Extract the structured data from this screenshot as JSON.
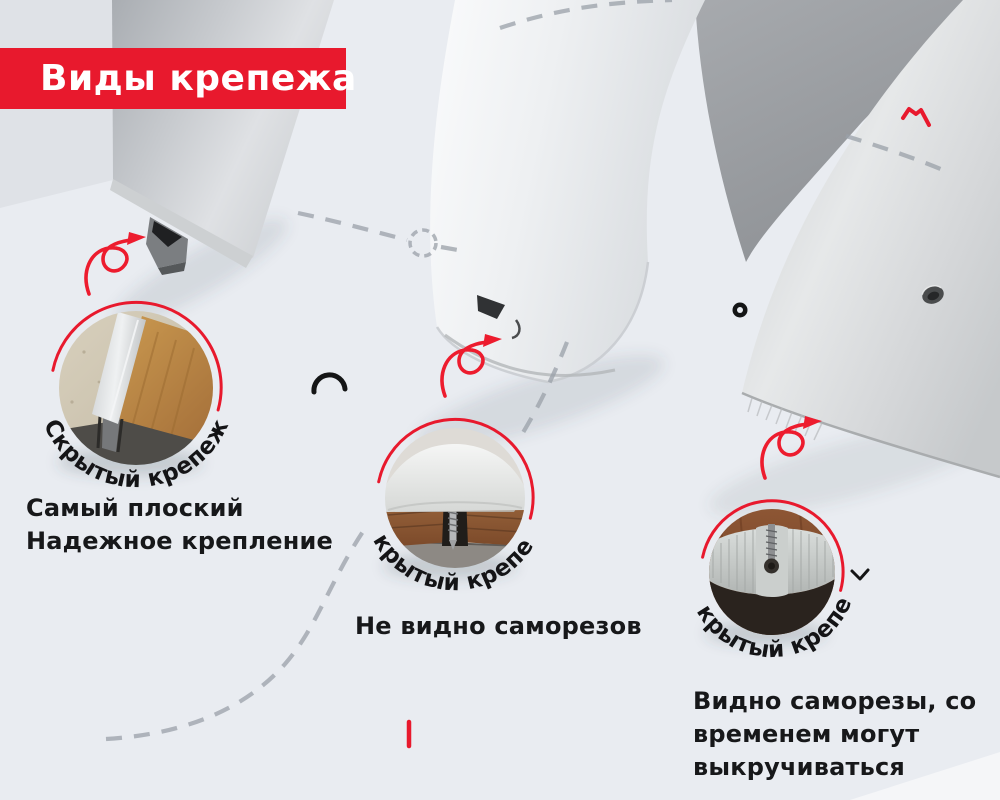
{
  "colors": {
    "background": "#e9ecf1",
    "accent_red": "#e8192d",
    "arrow_red": "#ed1c2e",
    "text": "#17181a",
    "dash_gray": "#9aa0a8"
  },
  "banner": {
    "title": "Виды крепежа"
  },
  "fasteners": [
    {
      "arc_label": "Скрытый крепеж",
      "lines": [
        "Самый плоский",
        "Надежное крепление"
      ]
    },
    {
      "arc_label": "Скрытый крепеж",
      "lines": [
        "Не видно саморезов"
      ]
    },
    {
      "arc_label": "Открытый крепеж",
      "lines": [
        "Видно саморезы, со",
        "временем могут",
        "выкручиваться"
      ]
    }
  ]
}
